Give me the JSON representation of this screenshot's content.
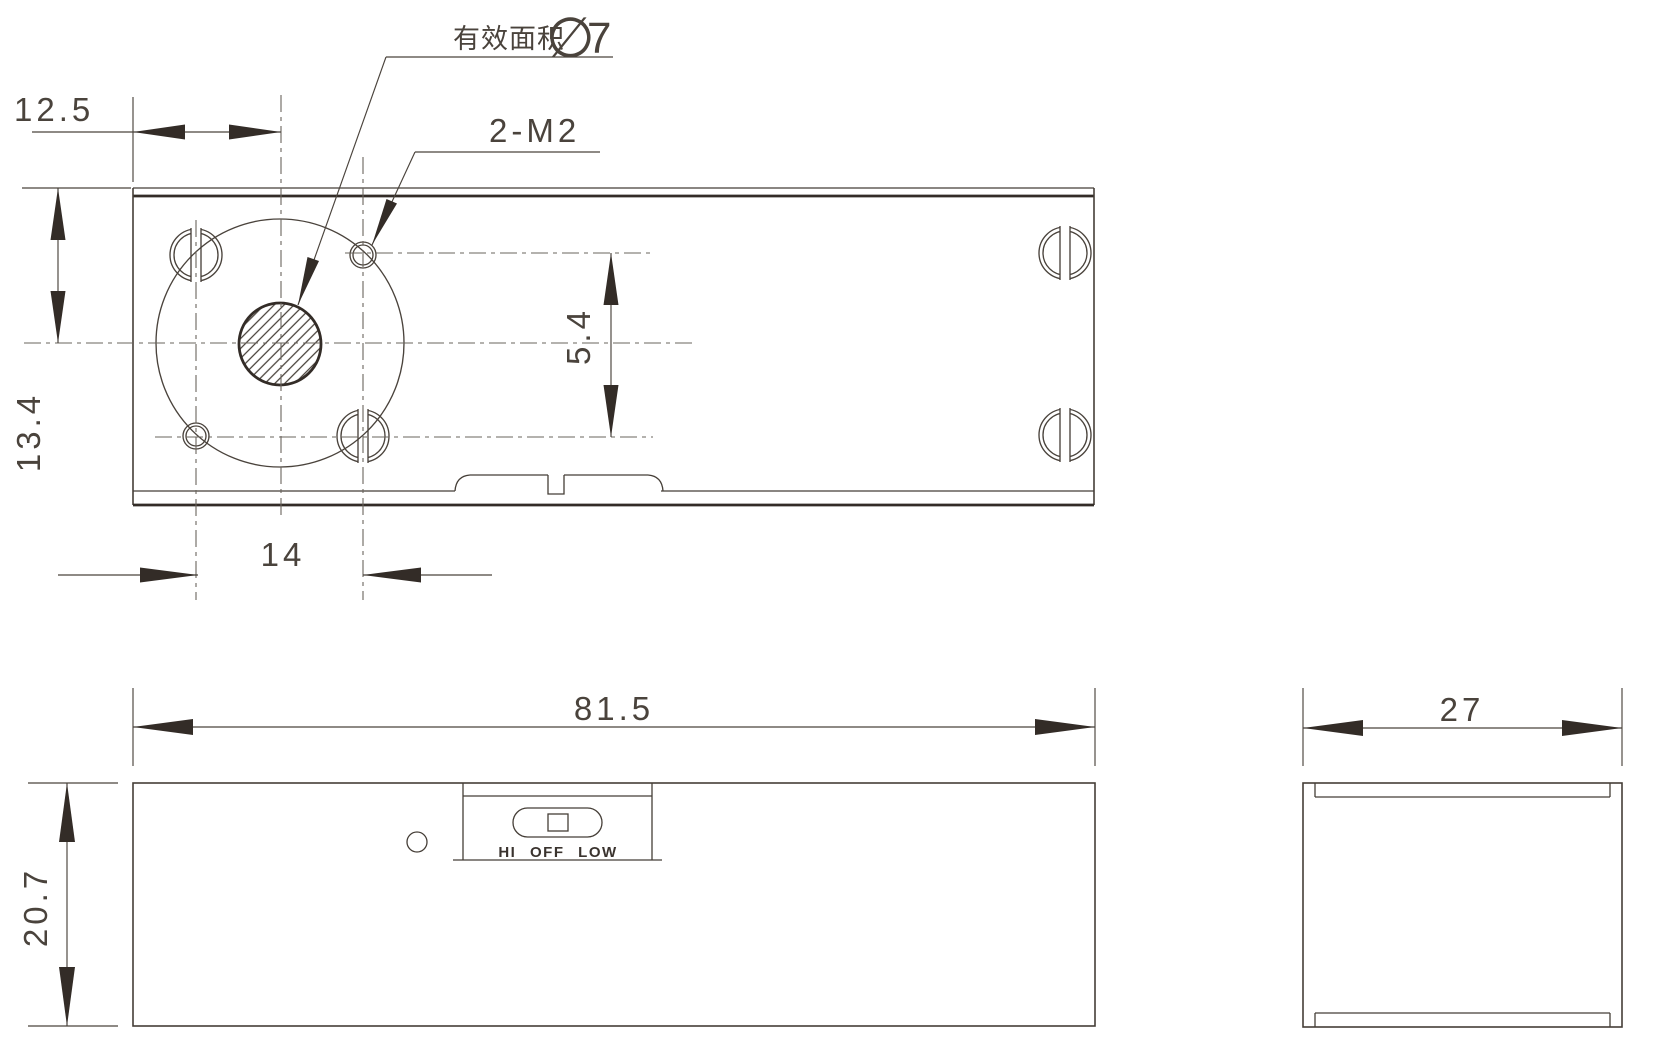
{
  "drawing": {
    "type": "engineering-drawing-three-views",
    "colors": {
      "background": "#ffffff",
      "line": "#453e37",
      "thick_line": "#332c27",
      "centerline": "#6a645d",
      "text": "#4a433c"
    },
    "dimensions": {
      "left_offset": "12.5",
      "top_offset": "13.4",
      "hole_spacing": "14",
      "hole_row_span": "5.4",
      "body_width": "81.5",
      "body_height": "20.7",
      "body_depth": "27"
    },
    "annotations": {
      "effective_area_label": "有效面积",
      "diameter_symbol": "∅",
      "diameter_value": "7",
      "thread_callout": "2-M2"
    },
    "front_view": {
      "switch_label": "HI OFF LOW"
    }
  }
}
